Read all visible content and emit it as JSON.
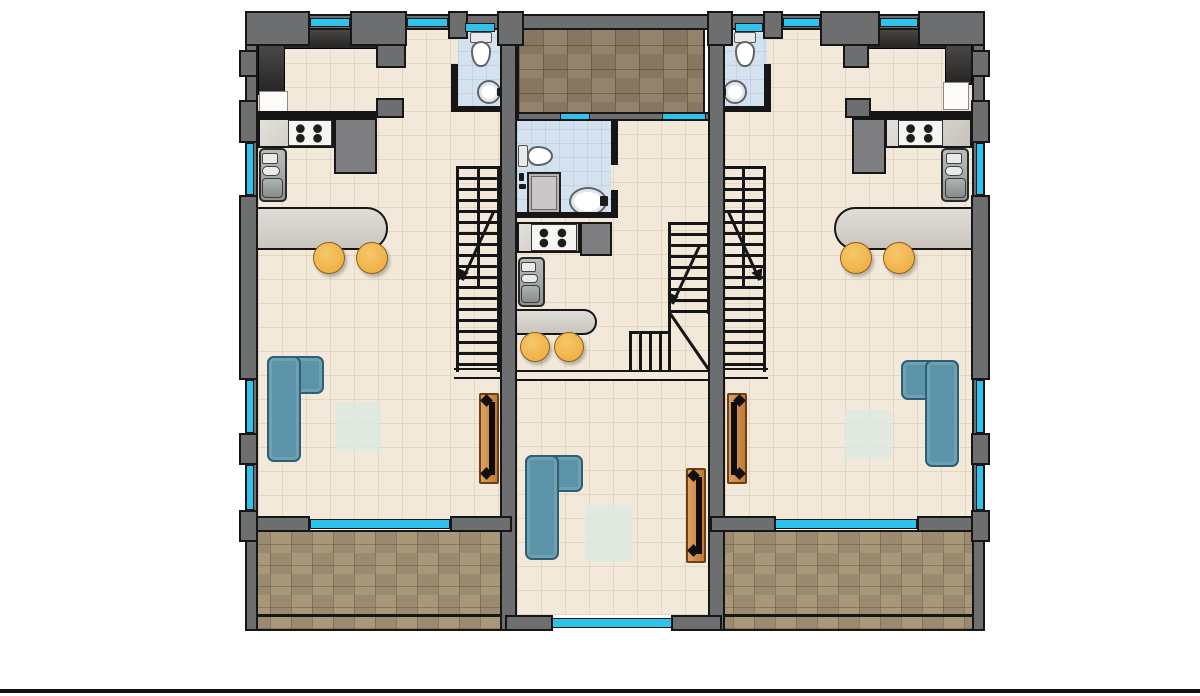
{
  "palette": {
    "bg": "#ffffff",
    "wall": "#6d6e70",
    "line": "#161616",
    "floor": "#f2e9db",
    "floor_line": "#cdbc9e66",
    "terrace": "#a89879",
    "terrace_dark": "#998a70",
    "terrace_top": "#93826c",
    "terrace_top_dark": "#887660",
    "bath": "#d4e2ef",
    "bath_line": "#9cb7d455",
    "window": "#2cc4ec",
    "counter_dark_1": "#4a4846",
    "counter_dark_2": "#262524",
    "marble_1": "#e3e0db",
    "marble_2": "#c6c2bb",
    "counter_gray": "#7f7f81",
    "stove": "#f7f5f2",
    "burner": "#1d1d1d",
    "sink_1": "#b9bdbb",
    "sink_2": "#8f9492",
    "island_1": "#e0ddd8",
    "island_2": "#c9c5be",
    "stool_1": "#f7c76b",
    "stool_2": "#eda838",
    "stool_edge": "#8a5f1d",
    "sofa": "#5b93a8",
    "sofa_edge": "#2e6075",
    "rug": "#dce8e2",
    "wood_1": "#dda05f",
    "wood_2": "#c07a35",
    "wood_edge": "#6d3f16",
    "tv": "#0d0d0d",
    "fixture": "#ffffff",
    "fixture_edge": "#5f6368",
    "washer": "#b9b2b4",
    "stairs": "#161616",
    "ground": "#151515"
  },
  "scene": {
    "type": "architectural-floor-plan",
    "view": "top-down",
    "units": [
      {
        "name": "left-unit",
        "rooms": [
          {
            "name": "kitchen",
            "features": [
              "dark-l-counter",
              "fridge",
              "gas-stove-4-burner",
              "wall-sink",
              "curved-island-counter",
              "two-bar-stools"
            ]
          },
          {
            "name": "bathroom",
            "features": [
              "toilet",
              "round-washbasin"
            ]
          },
          {
            "name": "staircase",
            "features": [
              "two-flights",
              "direction-arrow"
            ]
          },
          {
            "name": "living-room",
            "features": [
              "l-shaped-sofa",
              "rug",
              "tv-console"
            ]
          },
          {
            "name": "terrace",
            "position": "bottom",
            "finish": "brown-checker-tile"
          }
        ]
      },
      {
        "name": "center-unit",
        "rooms": [
          {
            "name": "roof-terrace",
            "position": "top",
            "finish": "brown-tile"
          },
          {
            "name": "bathroom",
            "features": [
              "toilet",
              "washing-machine",
              "oval-washbasin"
            ]
          },
          {
            "name": "kitchen",
            "features": [
              "gas-stove-4-burner",
              "wall-sink",
              "curved-island-counter",
              "two-bar-stools"
            ]
          },
          {
            "name": "staircase",
            "features": [
              "l-winder",
              "direction-arrow"
            ]
          },
          {
            "name": "living-room",
            "features": [
              "l-shaped-sofa",
              "rug",
              "tv-console"
            ]
          }
        ]
      },
      {
        "name": "right-unit",
        "mirror_of": "left-unit",
        "rooms": [
          {
            "name": "kitchen",
            "features": [
              "dark-l-counter",
              "fridge",
              "gas-stove-4-burner",
              "wall-sink",
              "curved-island-counter",
              "two-bar-stools"
            ]
          },
          {
            "name": "bathroom",
            "features": [
              "toilet",
              "round-washbasin"
            ]
          },
          {
            "name": "staircase",
            "features": [
              "two-flights",
              "direction-arrow"
            ]
          },
          {
            "name": "living-room",
            "features": [
              "l-shaped-sofa",
              "rug",
              "tv-console"
            ]
          },
          {
            "name": "terrace",
            "position": "bottom",
            "finish": "brown-checker-tile"
          }
        ]
      }
    ],
    "glazing": "cyan-window-strips-on-exterior-walls"
  }
}
